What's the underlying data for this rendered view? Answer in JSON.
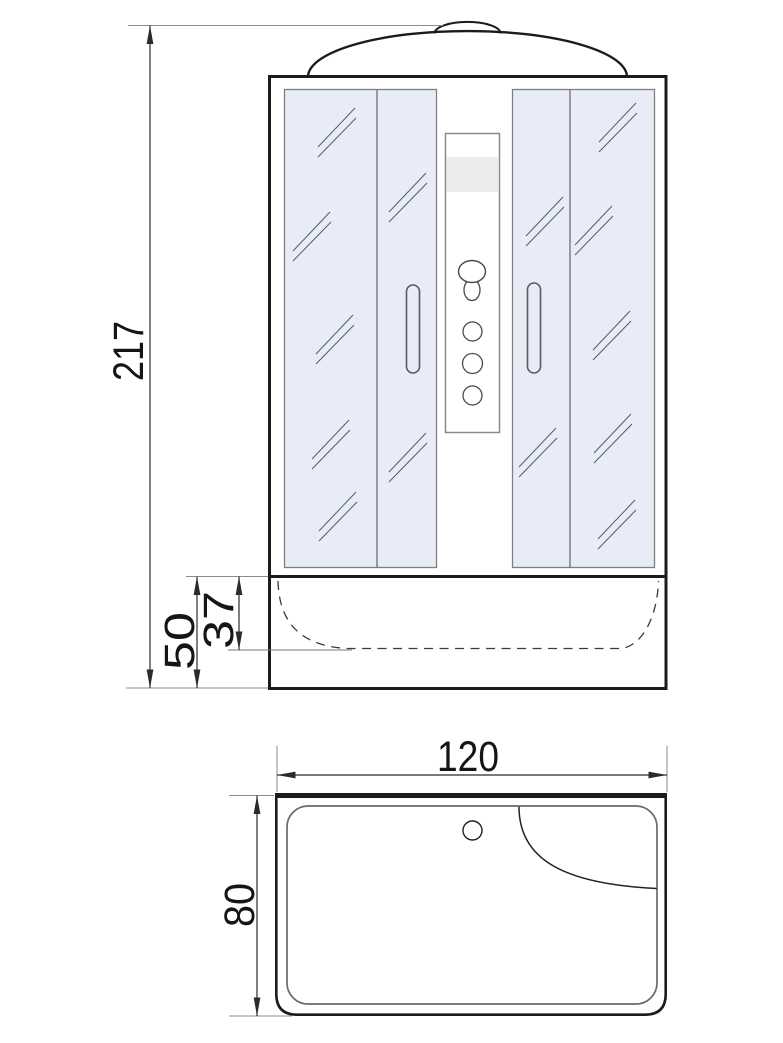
{
  "page": {
    "background": "#ffffff",
    "description": "Technical dimension drawing of a shower cabin: front elevation above, tray plan view below"
  },
  "front_view": {
    "name": "front elevation",
    "dims": {
      "overall_height": "217",
      "tray_height": "50",
      "tray_basin_depth": "37"
    }
  },
  "top_view": {
    "name": "tray plan view",
    "dims": {
      "width": "120",
      "depth": "80"
    }
  },
  "colors": {
    "glass_tint": "#e8ecf7",
    "outline": "#1b1b1b",
    "glass_border": "#7f7f7f",
    "dimension_line": "#2b2b2b",
    "extension_line": "#8c8c8c",
    "column_band": "#ececec"
  }
}
